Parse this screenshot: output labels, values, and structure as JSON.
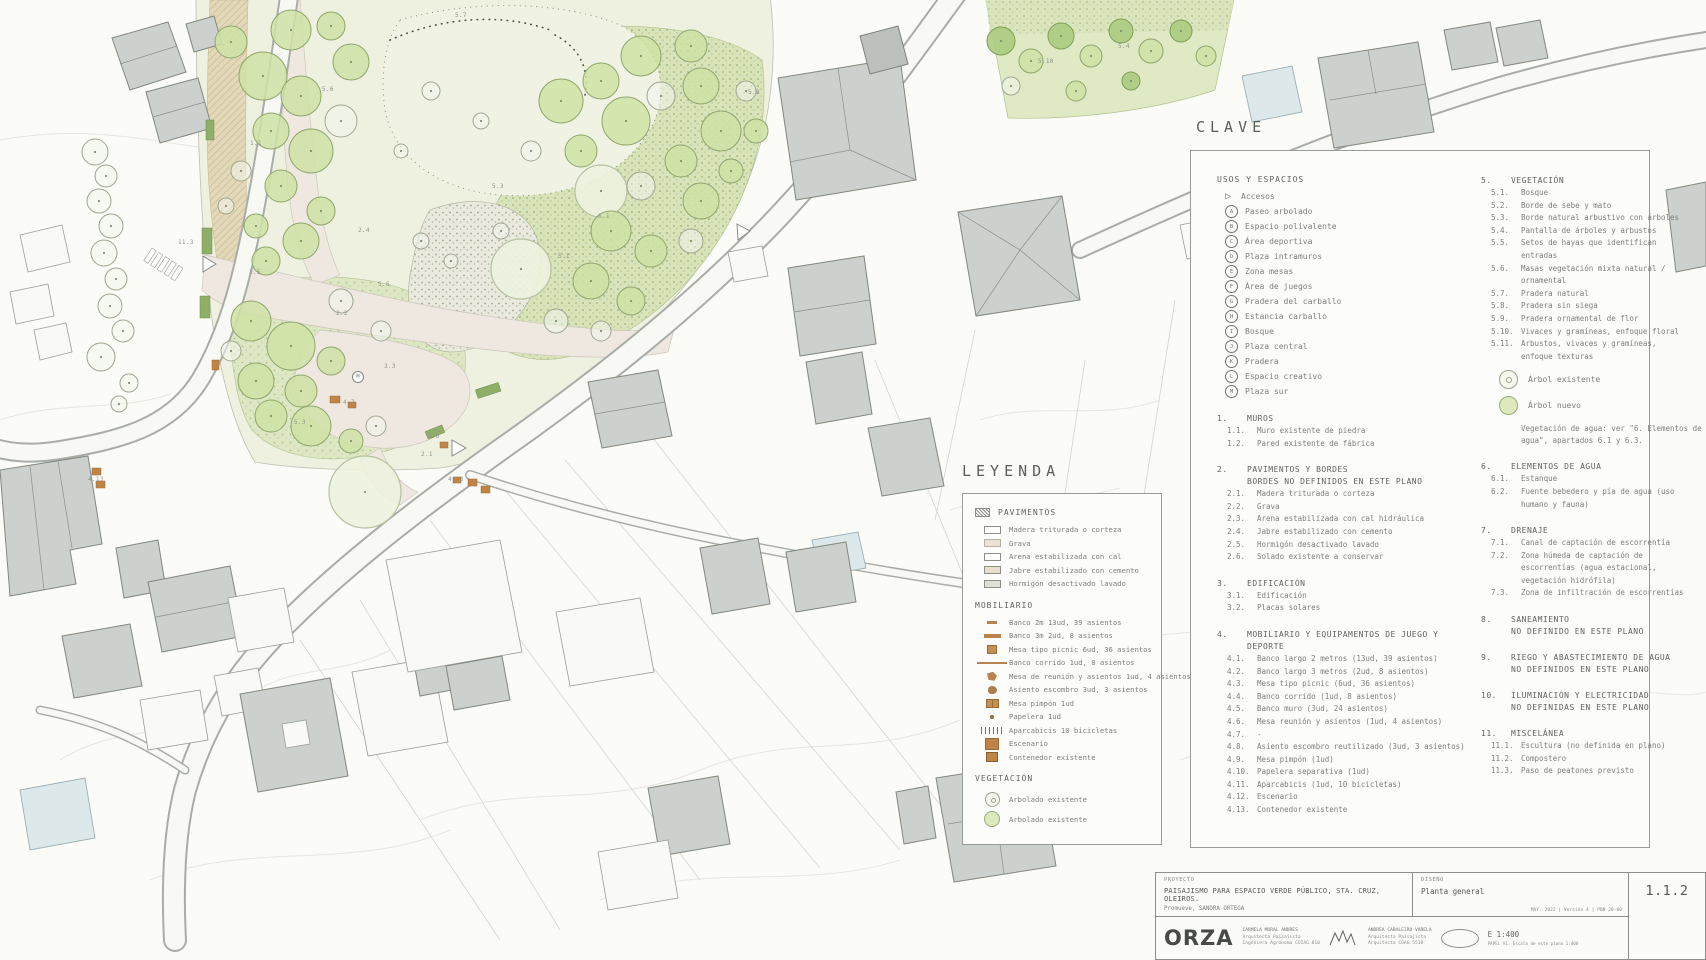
{
  "plan": {
    "clave": {
      "title": "CLAVE",
      "usos": {
        "heading": "USOS Y ESPACIOS",
        "access_label": "Accesos",
        "items": [
          {
            "key": "A",
            "label": "Paseo arbolado"
          },
          {
            "key": "B",
            "label": "Espacio polivalente"
          },
          {
            "key": "C",
            "label": "Área deportiva"
          },
          {
            "key": "D",
            "label": "Plaza intramuros"
          },
          {
            "key": "E",
            "label": "Zona mesas"
          },
          {
            "key": "F",
            "label": "Área de juegos"
          },
          {
            "key": "G",
            "label": "Pradera del carballo"
          },
          {
            "key": "H",
            "label": "Estancia carballo"
          },
          {
            "key": "I",
            "label": "Bosque"
          },
          {
            "key": "J",
            "label": "Plaza central"
          },
          {
            "key": "K",
            "label": "Pradera"
          },
          {
            "key": "L",
            "label": "Espacio creativo"
          },
          {
            "key": "M",
            "label": "Plaza sur"
          }
        ]
      },
      "left_sections": [
        {
          "num": "1.",
          "title": "MUROS",
          "items": [
            {
              "num": "1.1.",
              "label": "Muro existente de piedra"
            },
            {
              "num": "1.2.",
              "label": "Pared existente de fábrica"
            }
          ]
        },
        {
          "num": "2.",
          "title": "PAVIMENTOS Y BORDES",
          "subtitle": "BORDES NO DEFINIDOS EN ESTE PLANO",
          "items": [
            {
              "num": "2.1.",
              "label": "Madera triturada o corteza"
            },
            {
              "num": "2.2.",
              "label": "Grava"
            },
            {
              "num": "2.3.",
              "label": "Arena estabilizada con cal hidráulica"
            },
            {
              "num": "2.4.",
              "label": "Jabre estabilizado con cemento"
            },
            {
              "num": "2.5.",
              "label": "Hormigón desactivado lavado"
            },
            {
              "num": "2.6.",
              "label": "Solado existente a conservar"
            }
          ]
        },
        {
          "num": "3.",
          "title": "EDIFICACIÓN",
          "items": [
            {
              "num": "3.1.",
              "label": "Edificación"
            },
            {
              "num": "3.2.",
              "label": "Placas solares"
            }
          ]
        },
        {
          "num": "4.",
          "title": "MOBILIARIO Y EQUIPAMENTOS DE JUEGO Y DEPORTE",
          "items": [
            {
              "num": "4.1.",
              "label": "Banco largo 2 metros (13ud, 39 asientos)"
            },
            {
              "num": "4.2.",
              "label": "Banco largo 3 metros (2ud, 8 asientos)"
            },
            {
              "num": "4.3.",
              "label": "Mesa tipo picnic (6ud, 36 asientos)"
            },
            {
              "num": "4.4.",
              "label": "Banco corrido (1ud, 8 asientos)"
            },
            {
              "num": "4.5.",
              "label": "Banco muro (3ud, 24 asientos)"
            },
            {
              "num": "4.6.",
              "label": "Mesa reunión y asientos (1ud, 4 asientos)"
            },
            {
              "num": "4.7.",
              "label": "-"
            },
            {
              "num": "4.8.",
              "label": "Asiento escombro reutilizado (3ud, 3 asientos)"
            },
            {
              "num": "4.9.",
              "label": "Mesa pimpón (1ud)"
            },
            {
              "num": "4.10.",
              "label": "Papelera separativa (1ud)"
            },
            {
              "num": "4.11.",
              "label": "Aparcabicis (1ud, 10 bicicletas)"
            },
            {
              "num": "4.12.",
              "label": "Escenario"
            },
            {
              "num": "4.13.",
              "label": "Contenedor existente"
            }
          ]
        }
      ],
      "right_sections_a": [
        {
          "num": "5.",
          "title": "VEGETACIÓN",
          "items": [
            {
              "num": "5.1.",
              "label": "Bosque"
            },
            {
              "num": "5.2.",
              "label": "Borde de sebe y mato"
            },
            {
              "num": "5.3.",
              "label": "Borde natural arbustivo con árboles"
            },
            {
              "num": "5.4.",
              "label": "Pantalla de árboles y arbustos"
            },
            {
              "num": "5.5.",
              "label": "Setos de hayas que identifican entradas"
            },
            {
              "num": "5.6.",
              "label": "Masas vegetación mixta natural / ornamental"
            },
            {
              "num": "5.7.",
              "label": "Pradera natural"
            },
            {
              "num": "5.8.",
              "label": "Pradera sin siega"
            },
            {
              "num": "5.9.",
              "label": "Pradera ornamental de flor"
            },
            {
              "num": "5.10.",
              "label": "Vivaces y gramíneas, enfoque floral"
            },
            {
              "num": "5.11.",
              "label": "Arbustos, vivaces y gramíneas, enfoque texturas"
            }
          ]
        }
      ],
      "tree_existing_label": "Árbol existente",
      "tree_new_label": "Árbol nuevo",
      "agua_note": "Vegetación de agua: ver \"6. Elementos de agua\", apartados 6.1 y 6.3.",
      "right_sections_b": [
        {
          "num": "6.",
          "title": "ELEMENTOS DE AGUA",
          "items": [
            {
              "num": "6.1.",
              "label": "Estanque"
            },
            {
              "num": "6.2.",
              "label": "Fuente bebedero y pía de agua (uso humano y fauna)"
            }
          ]
        },
        {
          "num": "7.",
          "title": "DRENAJE",
          "items": [
            {
              "num": "7.1.",
              "label": "Canal de captación de escorrentía"
            },
            {
              "num": "7.2.",
              "label": "Zona húmeda de captación de escorrentías (agua estacional, vegetación hidrófila)"
            },
            {
              "num": "7.3.",
              "label": "Zona de infiltración de escorrentías"
            }
          ]
        },
        {
          "num": "8.",
          "title": "SANEAMIENTO",
          "subtitle": "NO DEFINIDO EN ESTE PLANO",
          "items": []
        },
        {
          "num": "9.",
          "title": "RIEGO Y ABASTECIMIENTO DE AGUA",
          "subtitle": "NO DEFINIDOS EN ESTE PLANO",
          "items": []
        },
        {
          "num": "10.",
          "title": "ILUMINACIÓN Y ELECTRICIDAD",
          "subtitle": "NO DEFINIDAS EN ESTE PLANO",
          "items": []
        },
        {
          "num": "11.",
          "title": "MISCELÁNEA",
          "items": [
            {
              "num": "11.1.",
              "label": "Escultura (no definida en plano)"
            },
            {
              "num": "11.2.",
              "label": "Compostero"
            },
            {
              "num": "11.3.",
              "label": "Paso de peatones previsto"
            }
          ]
        }
      ]
    },
    "leyenda": {
      "title": "LEYENDA",
      "groups": [
        {
          "heading": "PAVIMENTOS",
          "heading_icon": "hatch",
          "items": [
            {
              "swatch": "rect-white",
              "label": "Madera triturada o corteza"
            },
            {
              "swatch": "rect-grava",
              "label": "Grava"
            },
            {
              "swatch": "rect-white",
              "label": "Arena estabilizada con cal"
            },
            {
              "swatch": "rect-jabre",
              "label": "Jabre estabilizado con cemento"
            },
            {
              "swatch": "rect-hormigon",
              "label": "Hormigón desactivado lavado"
            }
          ]
        },
        {
          "heading": "MOBILIARIO",
          "items": [
            {
              "swatch": "bench2",
              "label": "Banco 2m 13ud, 39 asientos"
            },
            {
              "swatch": "bench3",
              "label": "Banco 3m 2ud, 8 asientos"
            },
            {
              "swatch": "picnic",
              "label": "Mesa tipo picnic 6ud, 36 asientos"
            },
            {
              "swatch": "corrido",
              "label": "Banco corrido 1ud, 8 asientos"
            },
            {
              "swatch": "reunion",
              "label": "Mesa de reunión y asientos 1ud, 4 asientos"
            },
            {
              "swatch": "escombro",
              "label": "Asiento escombro 3ud, 3 asientos"
            },
            {
              "swatch": "pimpon",
              "label": "Mesa pimpón 1ud"
            },
            {
              "swatch": "papelera",
              "label": "Papelera 1ud"
            },
            {
              "swatch": "bicis",
              "label": "Aparcabicis 10 bicicletas"
            },
            {
              "swatch": "escenario",
              "label": "Escenario"
            },
            {
              "swatch": "contenedor",
              "label": "Contenedor existente"
            }
          ]
        },
        {
          "heading": "VEGETACIÓN",
          "items": [
            {
              "swatch": "tree-existing",
              "label": "Arbolado existente"
            },
            {
              "swatch": "tree-new",
              "label": "Arbolado existente"
            }
          ]
        }
      ]
    },
    "titleblock": {
      "proyecto_label": "PROYECTO",
      "project_title": "PAISAJISMO PARA ESPACIO VERDE PÚBLICO, STA. CRUZ, OLEIROS.",
      "promoter": "Promueve, SANDRA ORTEGA",
      "diseno_label": "DISEÑO",
      "design_title": "Planta general",
      "revision": "MAY. 2022 | Versión 4 | PBN 20-00",
      "sheet_number": "1.1.2",
      "firm": "ORZA",
      "person1": {
        "name": "CARMELA MORAL ANDRES",
        "role1": "Arquitecta Paisajista",
        "role2": "Ingeniera Agrónoma COIAG 810"
      },
      "person2": {
        "name": "ANDREA CABALEIRO VARELA",
        "role1": "Arquitecta Paisajista",
        "role2": "Arquitecta COAG 5519"
      },
      "scale": "E 1:400",
      "scale_note": "PAPEL A1. Escala de este plano 1:400"
    },
    "plan_annotations": [
      {
        "text": "5.7",
        "x": 455,
        "y": 12
      },
      {
        "text": "5.6",
        "x": 322,
        "y": 86
      },
      {
        "text": "1.1",
        "x": 250,
        "y": 140
      },
      {
        "text": "5.3",
        "x": 492,
        "y": 183
      },
      {
        "text": "2.4",
        "x": 358,
        "y": 227
      },
      {
        "text": "11.3",
        "x": 178,
        "y": 239
      },
      {
        "text": "3.5",
        "x": 249,
        "y": 269
      },
      {
        "text": "5.6",
        "x": 378,
        "y": 281
      },
      {
        "text": "5.8",
        "x": 748,
        "y": 89
      },
      {
        "text": "2.2",
        "x": 336,
        "y": 310
      },
      {
        "text": "3.3",
        "x": 384,
        "y": 363
      },
      {
        "text": "4.7",
        "x": 343,
        "y": 399
      },
      {
        "text": "5.3",
        "x": 294,
        "y": 419
      },
      {
        "text": "4.6",
        "x": 428,
        "y": 433
      },
      {
        "text": "2.1",
        "x": 421,
        "y": 451
      },
      {
        "text": "4.13",
        "x": 88,
        "y": 476
      },
      {
        "text": "4.13",
        "x": 448,
        "y": 476
      },
      {
        "text": "5.1",
        "x": 558,
        "y": 253
      },
      {
        "text": "6.1",
        "x": 598,
        "y": 213
      },
      {
        "text": "5.10",
        "x": 1038,
        "y": 58
      },
      {
        "text": "5.4",
        "x": 1118,
        "y": 43
      }
    ],
    "plan_markers": [
      {
        "key": "M",
        "x": 352,
        "y": 371
      }
    ],
    "colors": {
      "tree_new_fill": "#cfe2a4",
      "furniture": "#c08447",
      "building_fill": "#cdd1cd",
      "water": "#dce8ea",
      "path": "#efe8e0"
    }
  }
}
